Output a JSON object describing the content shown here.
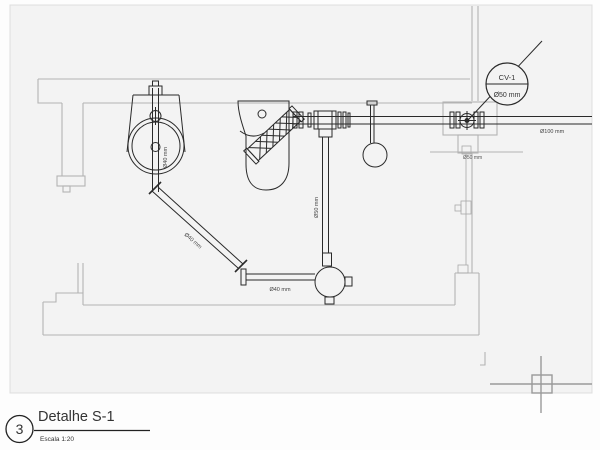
{
  "title_block": {
    "detail_number": "3",
    "title": "Detalhe S-1",
    "scale": "Escala 1:20"
  },
  "callout": {
    "tag": "CV-1",
    "size": "Ø50 mm"
  },
  "pipe_labels": {
    "basin_drain": "Ø40 mm",
    "diagonal_run": "Ø40 mm",
    "horizontal_run": "Ø40 mm",
    "wc_drop": "Ø50 mm",
    "vent_drop": "Ø50 mm",
    "main_line": "Ø100 mm"
  },
  "colors": {
    "plumbing": "#2a2a2a",
    "architecture": "#b3b3b3",
    "viewport_background": "#f3f3f3",
    "page_background": "#fdfdfd",
    "marker": "#9a9a9a"
  }
}
